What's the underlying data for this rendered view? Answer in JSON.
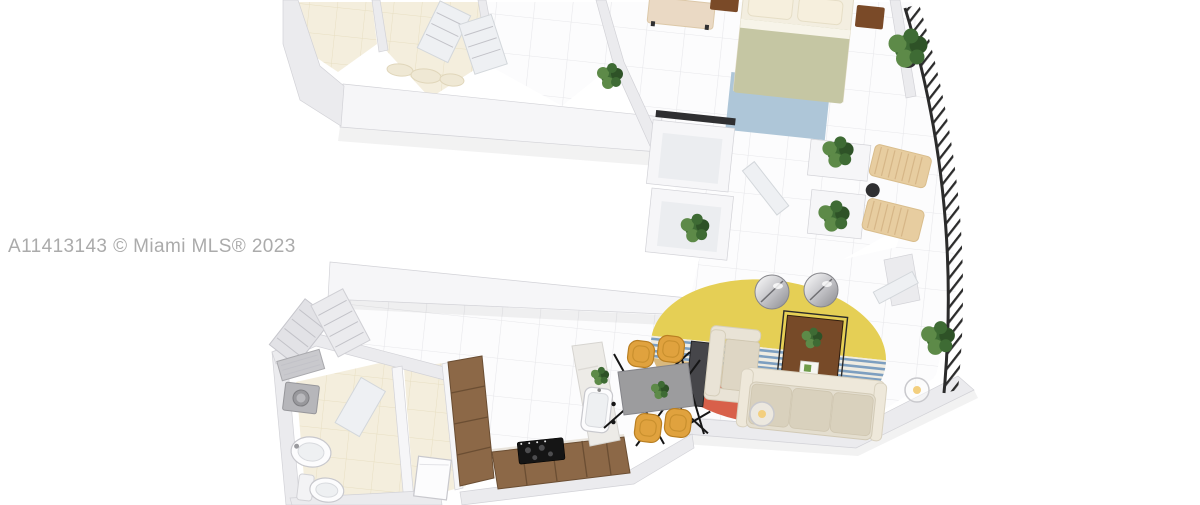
{
  "watermark": {
    "text": "A11413143 © Miami MLS® 2023"
  },
  "colors": {
    "background": "#ffffff",
    "watermark": "#ababab",
    "wall": "#ebebee",
    "wallBright": "#f6f6f8",
    "wallShade": "#dfdfe3",
    "wallEdge": "#d2d2d7",
    "floor": "#fcfcfd",
    "floorGrid": "#e7e7ea",
    "tileCream": "#f4eedd",
    "tileCreamGrid": "#e7dfc2",
    "duvet": "#c5c6a3",
    "linen": "#f3eee0",
    "pillow": "#f6efdd",
    "woodDark": "#7a4a28",
    "woodCabinet": "#8c6847",
    "woodEdge": "#6b4e33",
    "bedRugBlue": "#aec6d8",
    "benchBeige": "#ead9c4",
    "railing": "#2b2b2b",
    "loungeTan": "#e7cda0",
    "loungeSlat": "#d6b687",
    "plantGreen": "#3e6b34",
    "plantLight": "#5d8a48",
    "plantDark": "#2e5227",
    "potDark": "#2f2f31",
    "rugYellow": "#e5cf55",
    "rugStripeBlue": "#7d9fc0",
    "rugStripeBase": "#efece2",
    "rugTan": "#d9b97e",
    "rugRed": "#d8604a",
    "sofaCream": "#e4decf",
    "sofaCushion": "#d9d1bd",
    "sofaBack": "#eee8da",
    "armchairCream": "#e9e3d6",
    "armchairCushion": "#ded6c4",
    "tvDark": "#46464a",
    "legBlack": "#161616",
    "tableGray": "#9c9c9e",
    "chairOchre": "#e0a23e",
    "chairOchreDark": "#b97f22",
    "marble": "#edebe7",
    "marbleVein": "#dcd9d4",
    "applianceGray": "#b6b6ba",
    "fixtureWhite": "#fcfcfd",
    "doorGray": "#e2e2e6",
    "glowWarm": "#f3cf7e"
  }
}
